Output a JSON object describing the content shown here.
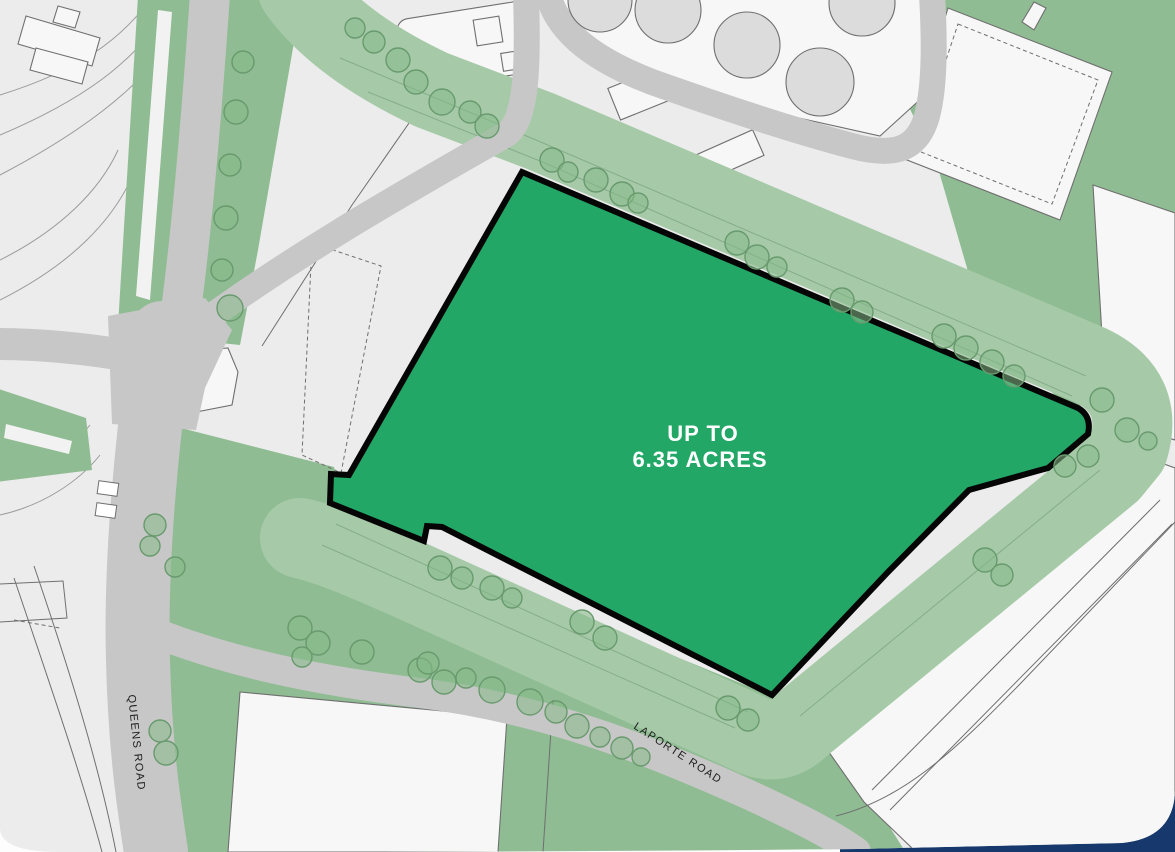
{
  "map": {
    "parcel": {
      "label_line1": "UP TO",
      "label_line2": "6.35 ACRES",
      "area_acres": 6.35
    },
    "roads": {
      "queens_road": "QUEENS ROAD",
      "laporte_road": "LAPORTE ROAD"
    }
  },
  "colors": {
    "parcel_green": "#22a767",
    "parcel_border": "#050505",
    "belt_green": "#a6caa8",
    "field_green": "#8fbc92",
    "road_grey": "#c7c7c7",
    "bg_grey": "#ececec",
    "plot_white": "#f7f7f7",
    "outline_grey": "#6f6f6f",
    "tank_grey": "#dcdcdc",
    "navy": "#16386c",
    "tree_fill": "#85b988",
    "tree_stroke": "#699a6e"
  }
}
